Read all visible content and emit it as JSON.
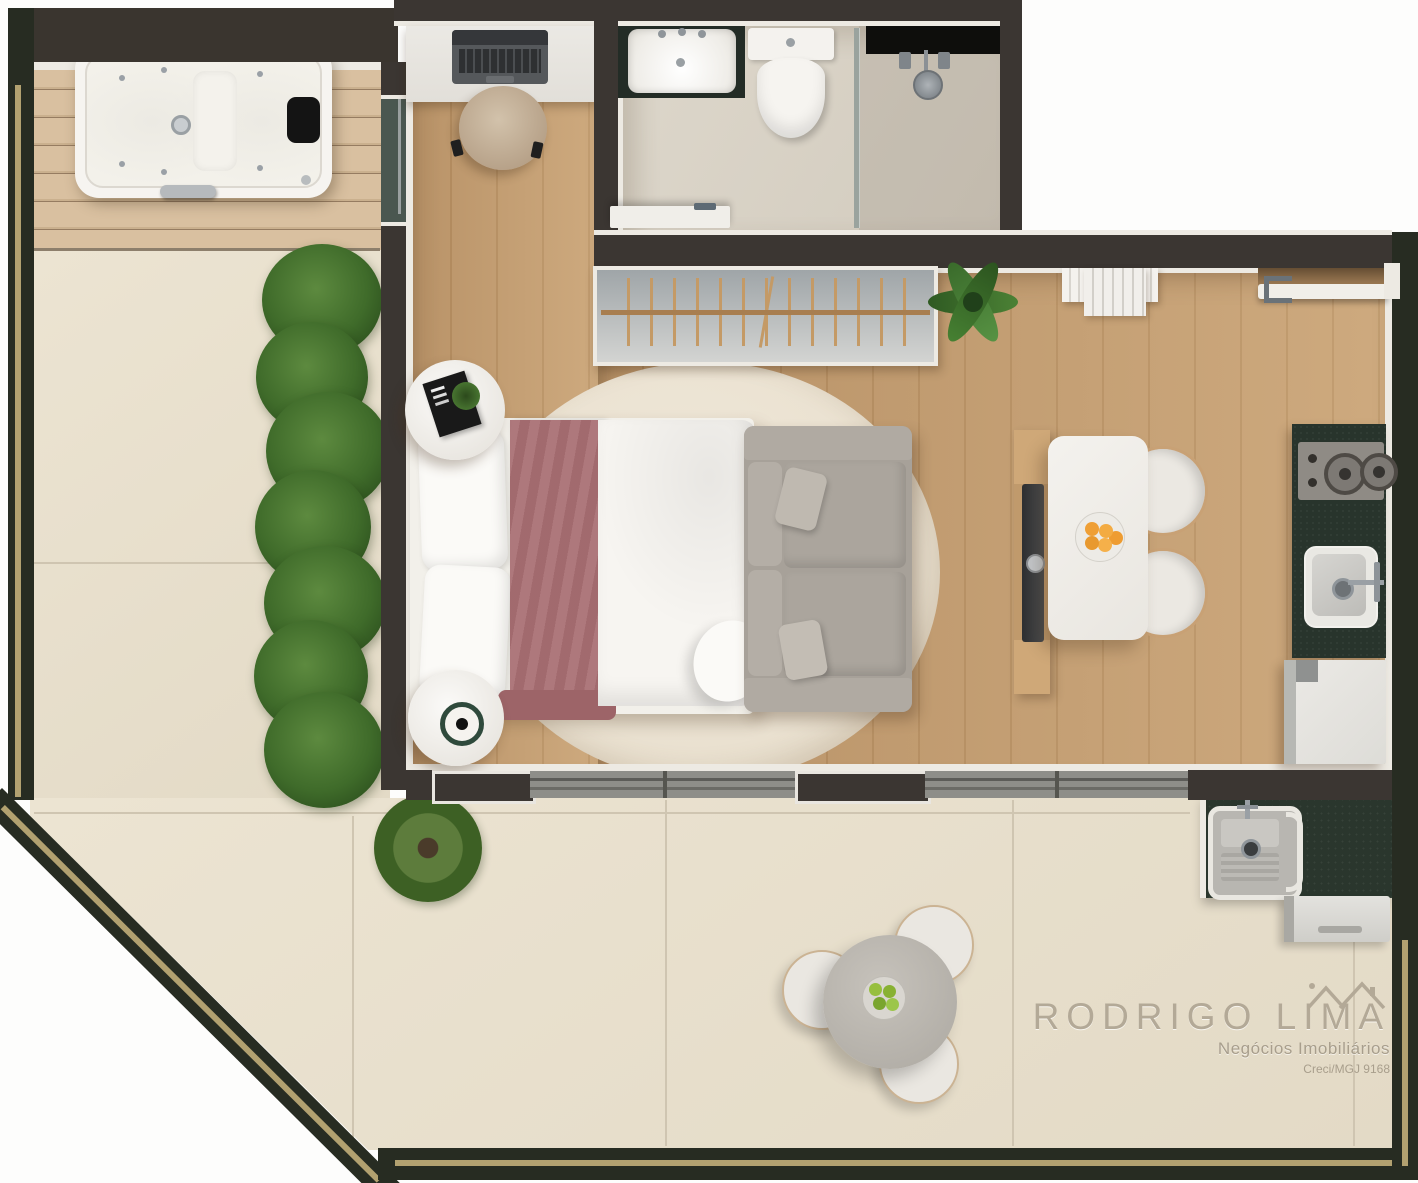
{
  "watermark": {
    "brand": "RODRIGO LIMA",
    "brand_left": "RODRIGO L",
    "brand_right": "IMA",
    "tagline": "Negócios Imobiliários",
    "license": "Creci/MGJ 9168"
  },
  "palette": {
    "interior_wall": "#3b3632",
    "outer_terrace_wall": "#272c22",
    "wall_trim": "#edeae3",
    "terrace_stripe": "#b2a170",
    "deck_wood": "#d7bd9d",
    "floor_wood": "#c19a6d",
    "terrace_tile": "#e8e0cd",
    "bathroom_tile": "#d9d3c7",
    "granite_counter": "#2a362d",
    "bed_runner": "#a86e72",
    "rug": "#ece3d2",
    "sofa_gray": "#a8a29a",
    "hedge_green": "#45702f",
    "watermark_text": "#aea48f"
  },
  "rooms": [
    "deck",
    "home-office-nook",
    "bathroom",
    "bedroom-living",
    "kitchen-dining",
    "service-area",
    "terrace"
  ],
  "furniture": [
    "jacuzzi",
    "desk-with-laptop",
    "office-chair",
    "bathroom-sink",
    "toilet",
    "shower",
    "open-wardrobe-rack",
    "double-bed",
    "nightstand",
    "sofa",
    "tv-panel",
    "dining-table",
    "dining-chair",
    "cooktop",
    "kitchen-sink",
    "refrigerator",
    "laundry-tank",
    "washing-machine",
    "outdoor-round-table",
    "outdoor-stool",
    "hedge",
    "potted-plant"
  ]
}
